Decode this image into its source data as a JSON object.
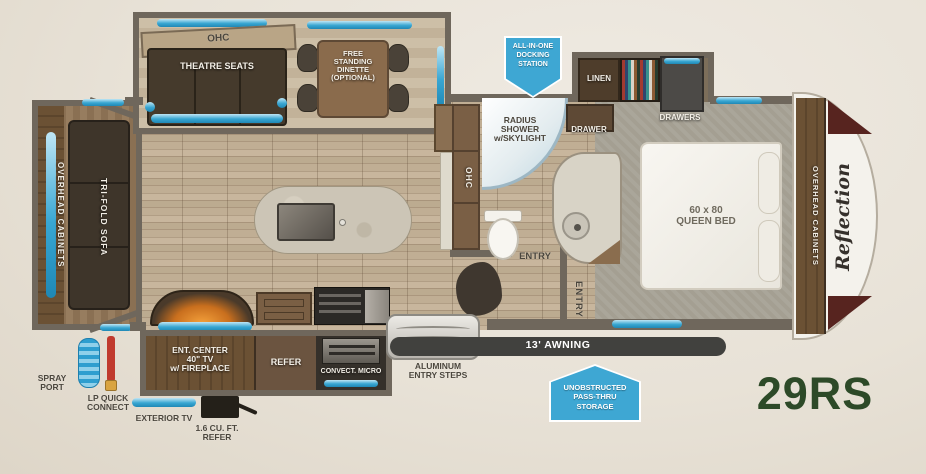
{
  "model": "29RS",
  "brand_logo": "Reflection",
  "colors": {
    "background": "#e8e2d7",
    "wall": "#6f675c",
    "accent_blue": "#38a6d2",
    "badge_blue": "#3ea7d3",
    "model_green": "#2d4a28",
    "awning_bar": "#41413e"
  },
  "living": {
    "ohc": "OHC",
    "theatre_seats": "THEATRE SEATS",
    "dinette_lines": [
      "FREE",
      "STANDING",
      "DINETTE",
      "(OPTIONAL)"
    ],
    "overhead_cabinets": "OVERHEAD CABINETS",
    "trifold_sofa": "TRI-FOLD SOFA"
  },
  "kitchen": {
    "pantry_ohc": "OHC",
    "ent_center_lines": [
      "ENT. CENTER",
      "40\" TV",
      "w/ FIREPLACE"
    ],
    "refer": "REFER",
    "convect_micro": "CONVECT. MICRO"
  },
  "bath": {
    "shower_lines": [
      "RADIUS",
      "SHOWER",
      "w/SKYLIGHT"
    ],
    "drawer": "DRAWER",
    "entry": "ENTRY"
  },
  "bedroom": {
    "linen": "LINEN",
    "drawers": "DRAWERS",
    "bed_lines": [
      "60 x 80",
      "QUEEN BED"
    ],
    "entry": "ENTRY",
    "overhead_cabinets": "OVERHEAD CABINETS"
  },
  "badges": {
    "docking_lines": [
      "ALL-IN-ONE",
      "DOCKING",
      "STATION"
    ],
    "passthru_lines": [
      "UNOBSTRUCTED",
      "PASS-THRU",
      "STORAGE"
    ]
  },
  "exterior": {
    "awning": "13' AWNING",
    "steps_lines": [
      "ALUMINUM",
      "ENTRY STEPS"
    ],
    "spray_port_lines": [
      "SPRAY",
      "PORT"
    ],
    "lp_lines": [
      "LP QUICK",
      "CONNECT"
    ],
    "exterior_tv": "EXTERIOR TV",
    "mini_refer_lines": [
      "1.6 CU. FT.",
      "REFER"
    ]
  }
}
